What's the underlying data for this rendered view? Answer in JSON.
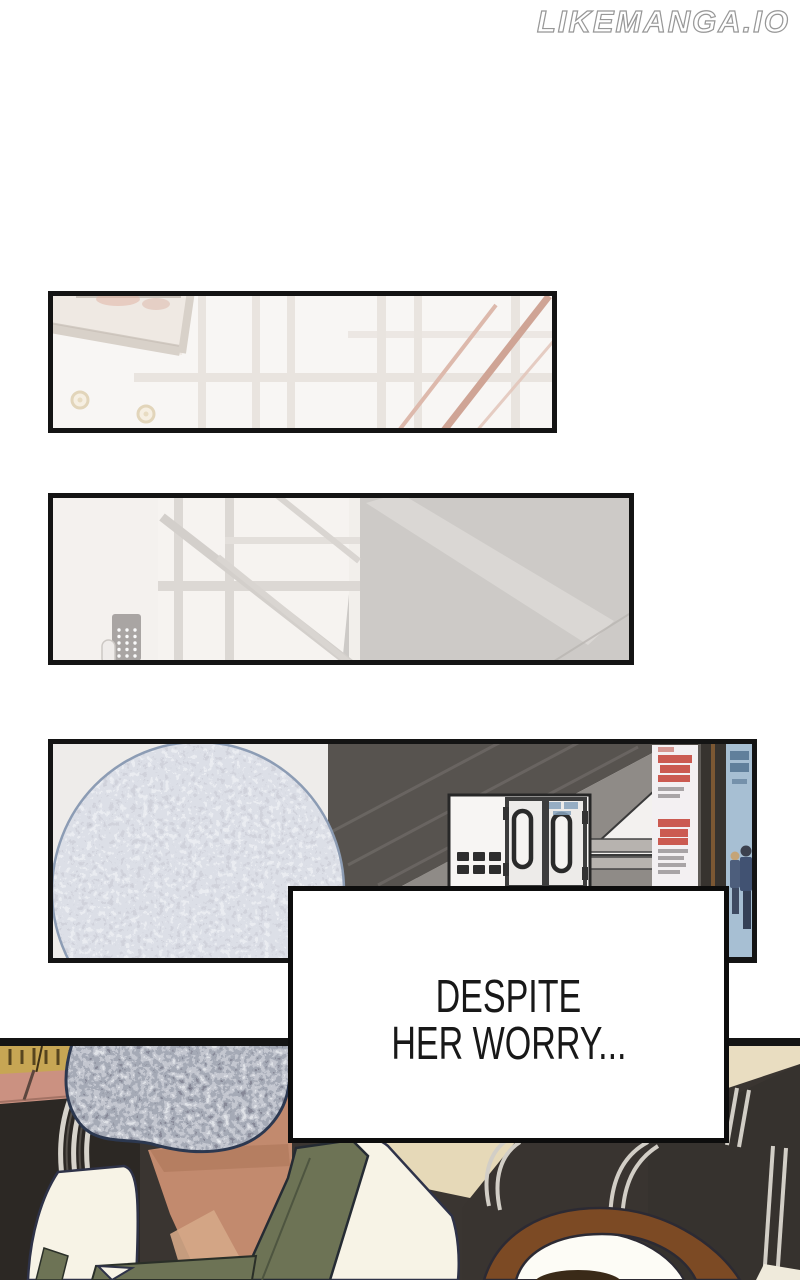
{
  "watermark": {
    "text": "LIKEMANGA.IO"
  },
  "caption": {
    "line1": "DESPITE",
    "line2": "HER WORRY...",
    "text_color": "#181818",
    "border_color": "#0d0d0d",
    "background": "#ffffff"
  },
  "panels": {
    "panel1": {
      "alt": "Washed-out hazy interior: dark picture-frame corner at top left, window mullions, pink stair railing diagonals, two small round knobs"
    },
    "panel2": {
      "alt": "Hazy stairwell: window grid with diagonal railing, gray stair wall at right, door keypad with dot buttons at left"
    },
    "panel3": {
      "alt": "Station interior: large pixelated censored head at left, striped dark escalator wall, white double-door gate machine, red-text poster, dark pillar and blue poster with two small figures"
    },
    "panel4": {
      "alt": "Waiting area: person with pixelated censored head wearing white shirt and olive vest among dark chairs with silver frames, gold items and salmon seats top left, brown-haired person at bottom right"
    }
  },
  "colors": {
    "page_background": "#ffffff",
    "panel_border": "#141414",
    "skin": "#c28a6e",
    "olive_vest": "#6d7355",
    "hair_brown": "#7c4a24",
    "chair_dark": "#35312e",
    "chair_stripe": "#d5d1c9",
    "gold_items": "#c7a654",
    "salmon_seat": "#cb9181",
    "poster_red": "#c74a40",
    "poster_blue_bg": "#a7bfd3",
    "beige_floor": "#e6d9b8",
    "mosaic_light": "#aab4c2",
    "mosaic_dark": "#4a5260"
  }
}
